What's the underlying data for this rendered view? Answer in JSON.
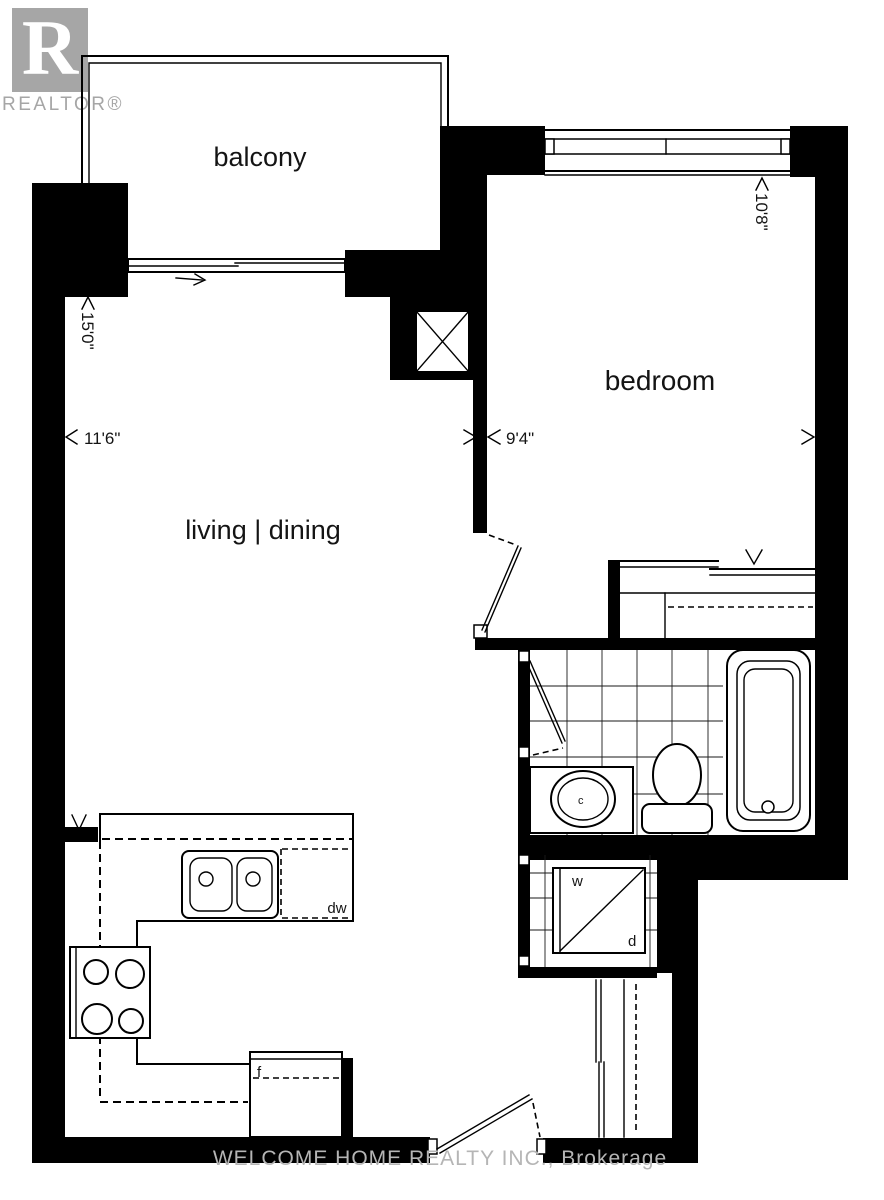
{
  "logo": {
    "letter": "R",
    "brand": "REALTOR®"
  },
  "labels": {
    "balcony": "balcony",
    "bedroom": "bedroom",
    "living_dining": "living | dining"
  },
  "dimensions": {
    "living_width": "11'6\"",
    "living_length": "15'0\"",
    "bedroom_width": "9'4\"",
    "bedroom_length": "10'8\""
  },
  "fixtures": {
    "dishwasher": "dw",
    "fridge": "f",
    "washer": "w",
    "dryer": "d",
    "sink_drain": "c"
  },
  "watermark": "WELCOME HOME REALTY INC., Brokerage",
  "colors": {
    "wall": "#000000",
    "background": "#ffffff",
    "logo_gray": "#a6a6a6",
    "watermark_gray": "#b5b5b5",
    "white": "#ffffff"
  }
}
